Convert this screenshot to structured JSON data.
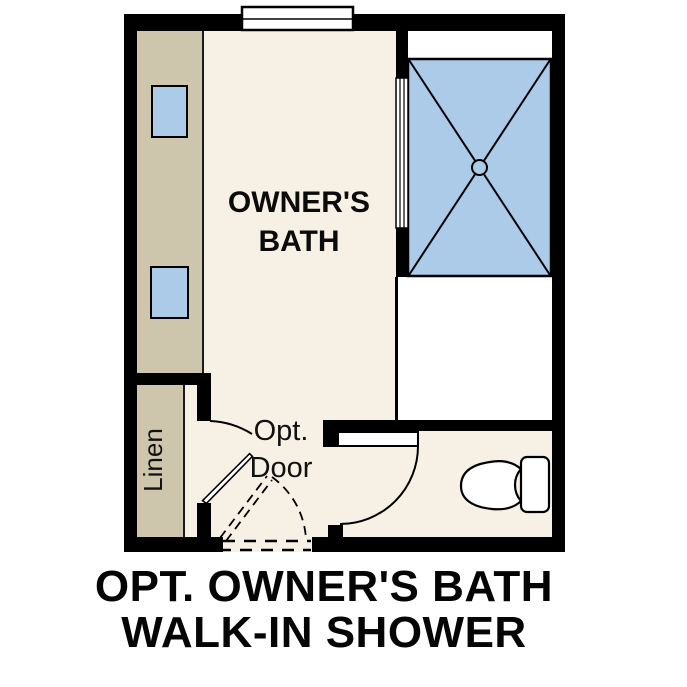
{
  "rooms": {
    "owners_bath": {
      "label_line1": "OWNER'S",
      "label_line2": "BATH"
    },
    "linen_closet": {
      "label": "Linen"
    }
  },
  "annotations": {
    "optional_door": {
      "line1": "Opt.",
      "line2": "Door"
    }
  },
  "caption": {
    "line1": "OPT. OWNER'S BATH",
    "line2": "WALK-IN SHOWER"
  },
  "fixtures": {
    "icons": [
      "walk-in-shower-pan-icon",
      "shower-drain-icon",
      "vanity-sink-icon",
      "vanity-sink-icon",
      "toilet-icon",
      "window-icon",
      "door-swing-icon",
      "optional-door-swing-icon",
      "shower-glass-panel-icon"
    ]
  },
  "colors": {
    "wall_black": "#000000",
    "floor_cream": "#F7F0E4",
    "cabinet_tan": "#CEC5AD",
    "fixture_blue": "#ACCBE9",
    "background_white": "#FFFFFF"
  }
}
